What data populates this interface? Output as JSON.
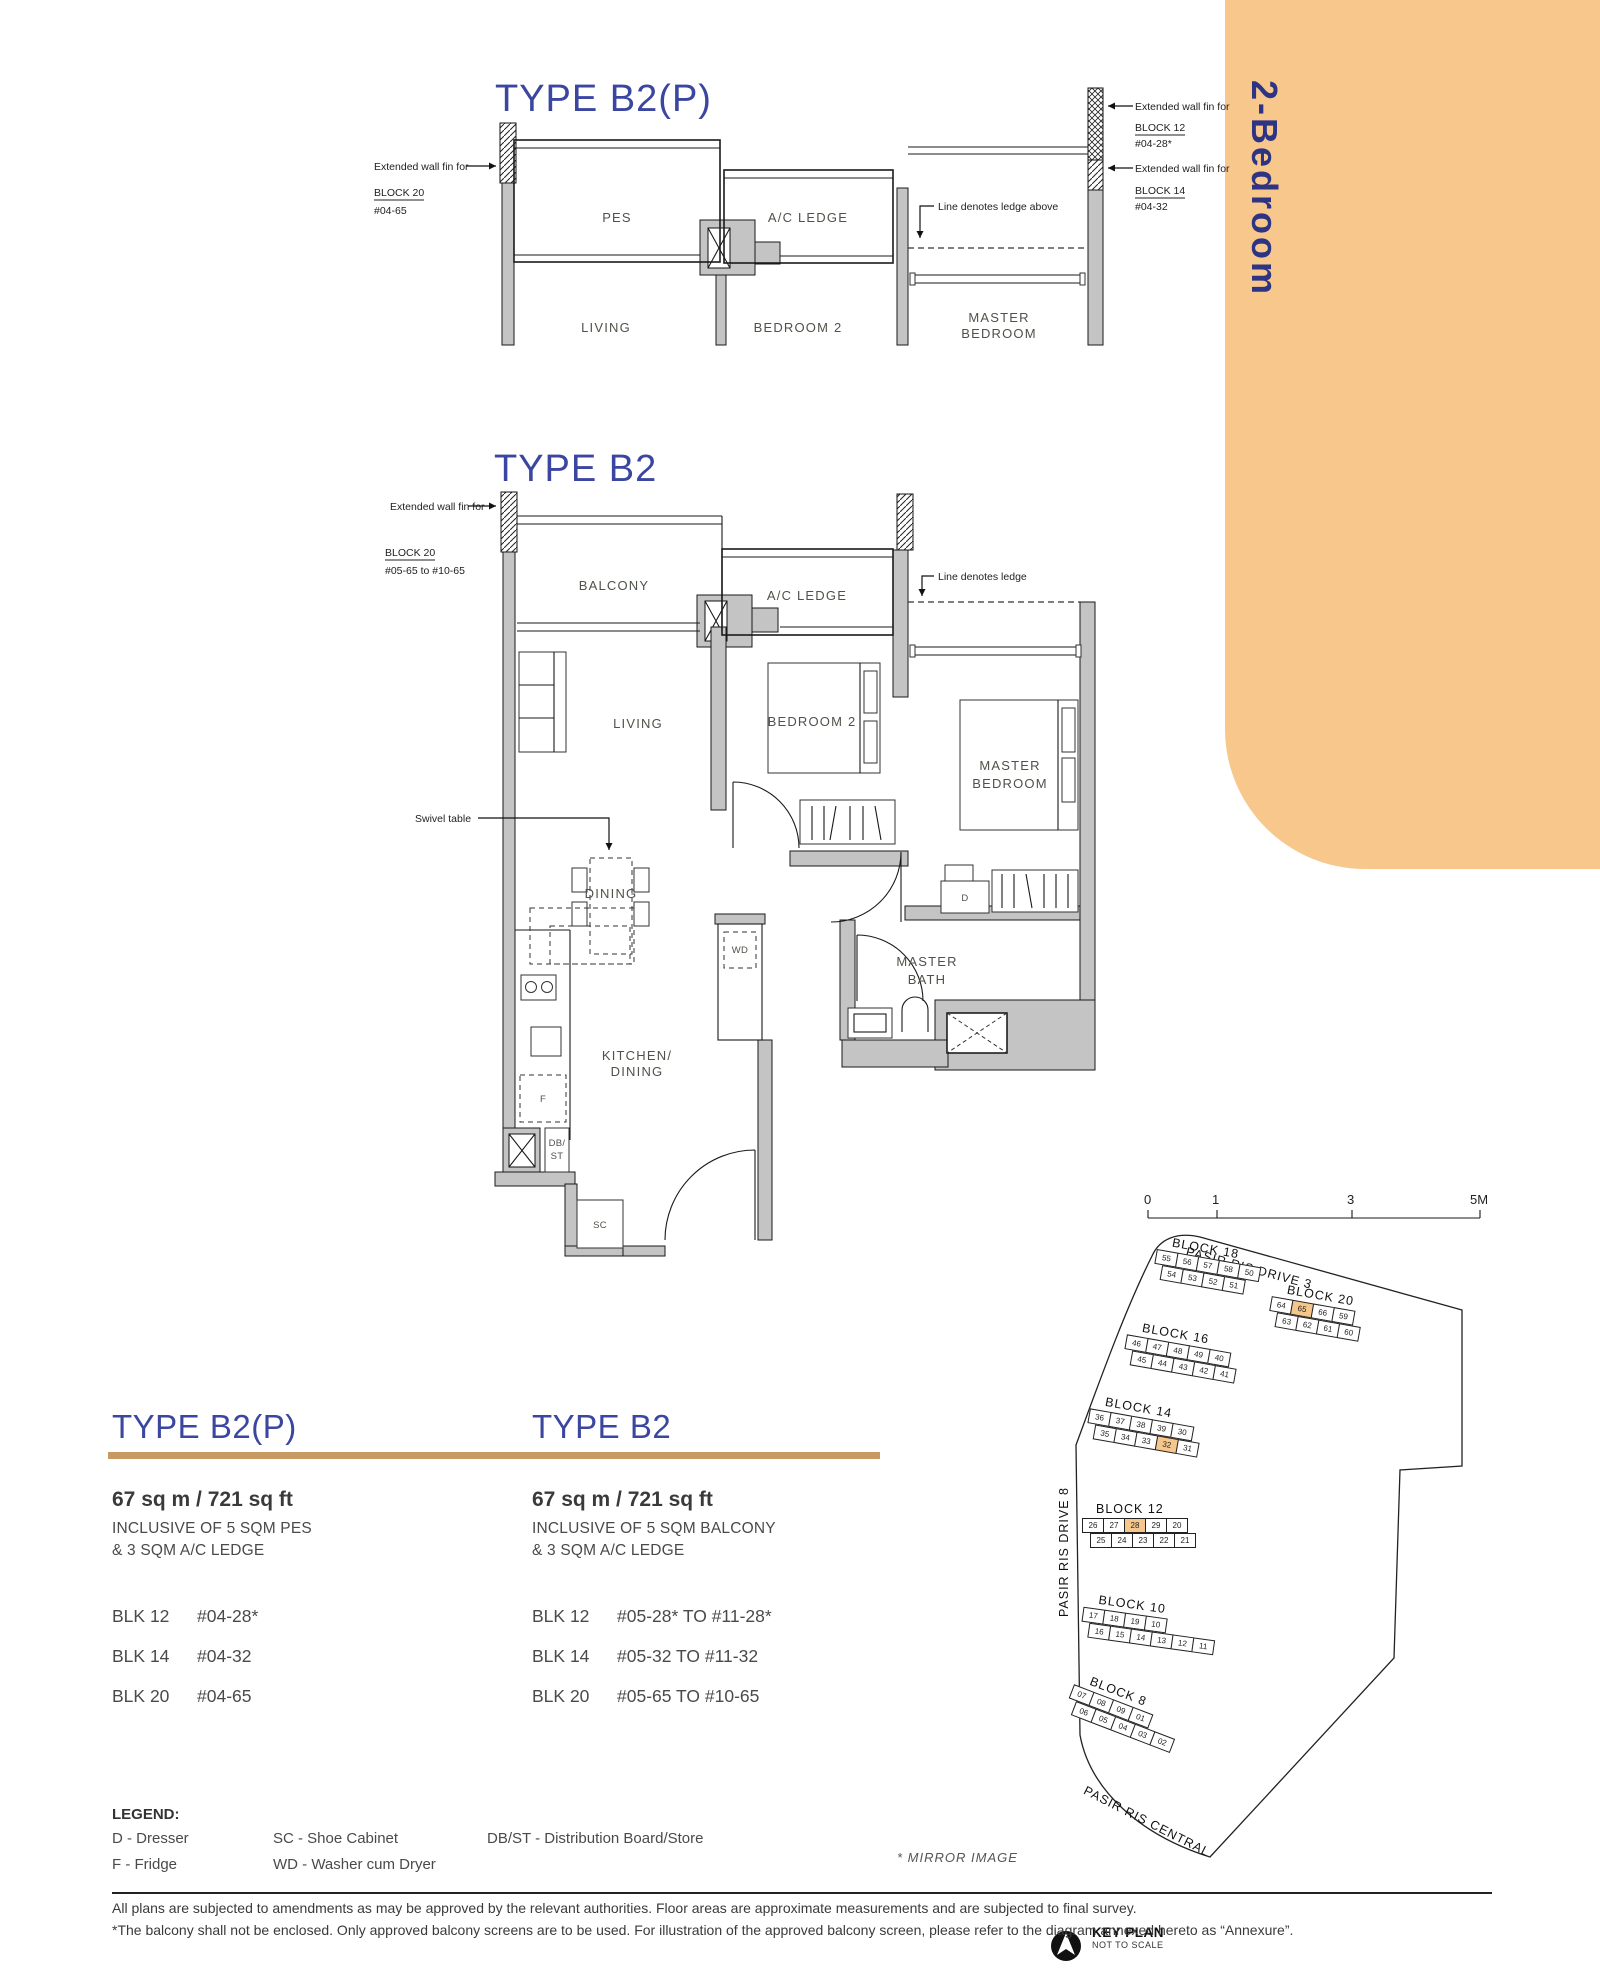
{
  "tab": {
    "label": "2-Bedroom"
  },
  "plan_b2p": {
    "title": "TYPE B2(P)",
    "ann_left": {
      "line1": "Extended wall fin for",
      "block": "BLOCK 20",
      "unit": "#04-65"
    },
    "ann_right1": {
      "line1": "Extended wall fin for",
      "block": "BLOCK 12",
      "unit": "#04-28*"
    },
    "ann_right2": {
      "line1": "Extended wall fin for",
      "block": "BLOCK 14",
      "unit": "#04-32"
    },
    "ledge_note": "Line denotes ledge above",
    "rooms": {
      "pes": "PES",
      "ac_ledge": "A/C LEDGE",
      "living": "LIVING",
      "bedroom2": "BEDROOM 2",
      "master1": "MASTER",
      "master2": "BEDROOM"
    }
  },
  "plan_b2": {
    "title": "TYPE B2",
    "ann_left": {
      "line1": "Extended wall fin for",
      "block": "BLOCK 20",
      "unit": "#05-65 to #10-65"
    },
    "ledge_note": "Line denotes ledge",
    "swivel_note": "Swivel table",
    "rooms": {
      "balcony": "BALCONY",
      "ac_ledge": "A/C LEDGE",
      "living": "LIVING",
      "bedroom2": "BEDROOM 2",
      "master1": "MASTER",
      "master2": "BEDROOM",
      "dining": "DINING",
      "wd": "WD",
      "bath1": "MASTER",
      "bath2": "BATH",
      "kitchen1": "KITCHEN/",
      "kitchen2": "DINING",
      "d": "D",
      "f": "F",
      "db1": "DB/",
      "db2": "ST",
      "sc": "SC"
    }
  },
  "info_b2p": {
    "title": "TYPE B2(P)",
    "area": "67 sq m / 721 sq ft",
    "inc1": "INCLUSIVE OF 5 SQM PES",
    "inc2": "& 3 SQM A/C LEDGE",
    "units": [
      {
        "blk": "BLK 12",
        "no": "#04-28*"
      },
      {
        "blk": "BLK 14",
        "no": "#04-32"
      },
      {
        "blk": "BLK 20",
        "no": "#04-65"
      }
    ]
  },
  "info_b2": {
    "title": "TYPE B2",
    "area": "67 sq m / 721 sq ft",
    "inc1": "INCLUSIVE OF 5 SQM BALCONY",
    "inc2": "& 3 SQM A/C LEDGE",
    "units": [
      {
        "blk": "BLK 12",
        "no": "#05-28* TO #11-28*"
      },
      {
        "blk": "BLK 14",
        "no": "#05-32 TO #11-32"
      },
      {
        "blk": "BLK 20",
        "no": "#05-65 TO #10-65"
      }
    ]
  },
  "key_plan": {
    "scale_labels": [
      "0",
      "1",
      "3",
      "5M"
    ],
    "streets": {
      "top": "PASIR RIS DRIVE 3",
      "left": "PASIR RIS DRIVE 8",
      "bottom": "PASIR RIS CENTRAL"
    },
    "mirror_note": "* MIRROR IMAGE",
    "key_plan_label": "KEY PLAN",
    "not_to_scale": "NOT TO SCALE",
    "blocks": [
      {
        "name": "BLOCK 18",
        "row1": [
          "55",
          "56",
          "57",
          "58",
          "50"
        ],
        "row2": [
          "54",
          "53",
          "52",
          "51"
        ],
        "highlight": []
      },
      {
        "name": "BLOCK 20",
        "row1": [
          "64",
          "65",
          "66",
          "59"
        ],
        "row2": [
          "63",
          "62",
          "61",
          "60"
        ],
        "highlight": [
          "65"
        ]
      },
      {
        "name": "BLOCK 16",
        "row1": [
          "46",
          "47",
          "48",
          "49",
          "40"
        ],
        "row2": [
          "45",
          "44",
          "43",
          "42",
          "41"
        ],
        "highlight": []
      },
      {
        "name": "BLOCK 14",
        "row1": [
          "36",
          "37",
          "38",
          "39",
          "30"
        ],
        "row2": [
          "35",
          "34",
          "33",
          "32",
          "31"
        ],
        "highlight": [
          "32"
        ]
      },
      {
        "name": "BLOCK 12",
        "row1": [
          "26",
          "27",
          "28",
          "29",
          "20"
        ],
        "row2": [
          "25",
          "24",
          "23",
          "22",
          "21"
        ],
        "highlight": [
          "28"
        ]
      },
      {
        "name": "BLOCK 10",
        "row1": [
          "17",
          "18",
          "19",
          "10"
        ],
        "row2": [
          "16",
          "15",
          "14",
          "13",
          "12",
          "11"
        ],
        "highlight": []
      },
      {
        "name": "BLOCK 8",
        "row1": [
          "07",
          "08",
          "09",
          "01"
        ],
        "row2": [
          "06",
          "05",
          "04",
          "03",
          "02"
        ],
        "highlight": []
      }
    ]
  },
  "legend": {
    "title": "LEGEND:",
    "col1": [
      "D - Dresser",
      "F - Fridge"
    ],
    "col2": [
      "SC - Shoe Cabinet",
      "WD - Washer cum Dryer"
    ],
    "col3": [
      "DB/ST - Distribution Board/Store"
    ]
  },
  "footer": {
    "line1": "All plans are subjected to amendments as may be approved by the relevant authorities. Floor areas are approximate measurements and are subjected to final survey.",
    "line2": "*The balcony shall not be enclosed. Only approved balcony screens are to be used. For illustration of the approved balcony screen, please refer to the diagram annexed hereto as “Annexure”."
  },
  "colors": {
    "accent_navy": "#3A46A0",
    "gold": "#C69A62",
    "tab_orange": "#F7C78C",
    "highlight_orange": "#F5C78C"
  }
}
